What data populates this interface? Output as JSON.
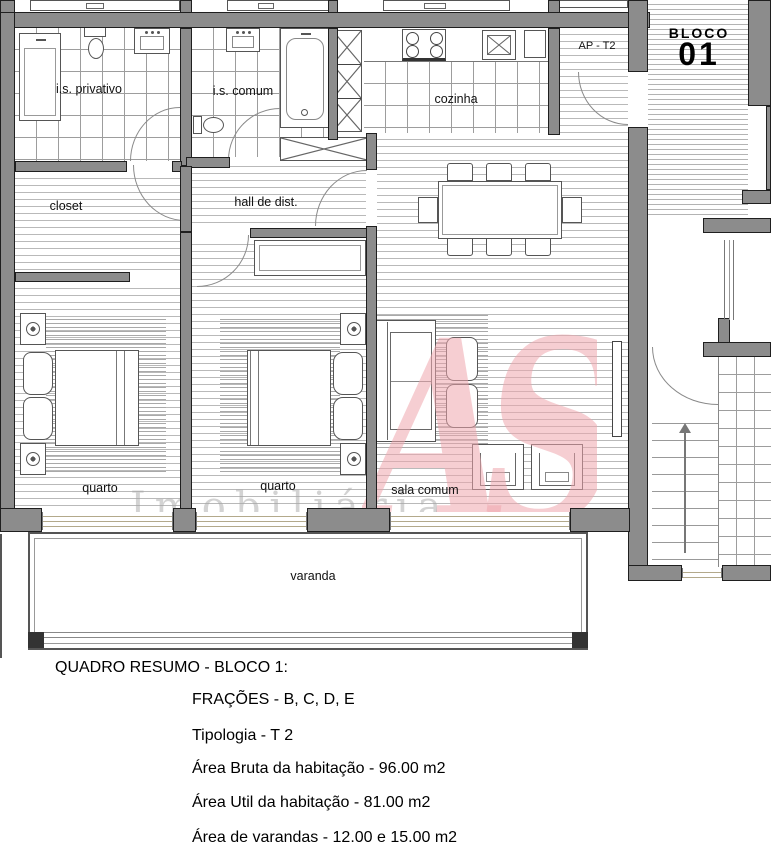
{
  "plan": {
    "block_line1": "BLOCO",
    "block_line2": "01",
    "unit_label": "AP - T2",
    "logo_monogram": "AS",
    "watermark_text": "Imobiliária",
    "rooms": {
      "is_privativo": "i.s. privativo",
      "is_comum": "i.s. comum",
      "cozinha": "cozinha",
      "closet": "closet",
      "hall": "hall de dist.",
      "quarto_1": "quarto",
      "quarto_2": "quarto",
      "sala": "sala comum",
      "varanda": "varanda"
    }
  },
  "summary": {
    "title": "QUADRO RESUMO - BLOCO 1:",
    "fracoes": "FRAÇÕES - B, C, D, E",
    "tipologia": "Tipologia - T 2",
    "area_bruta": "Área Bruta da habitação - 96.00 m2",
    "area_util": "Área Util da habitação - 81.00 m2",
    "area_varandas": "Área de varandas - 12.00 e 15.00 m2"
  },
  "colors": {
    "wall_gray": "#8c8c8c",
    "logo_pink": "#efa6ad",
    "watermark_gray": "#a8a8a8",
    "window_sill": "#b3a98b"
  }
}
